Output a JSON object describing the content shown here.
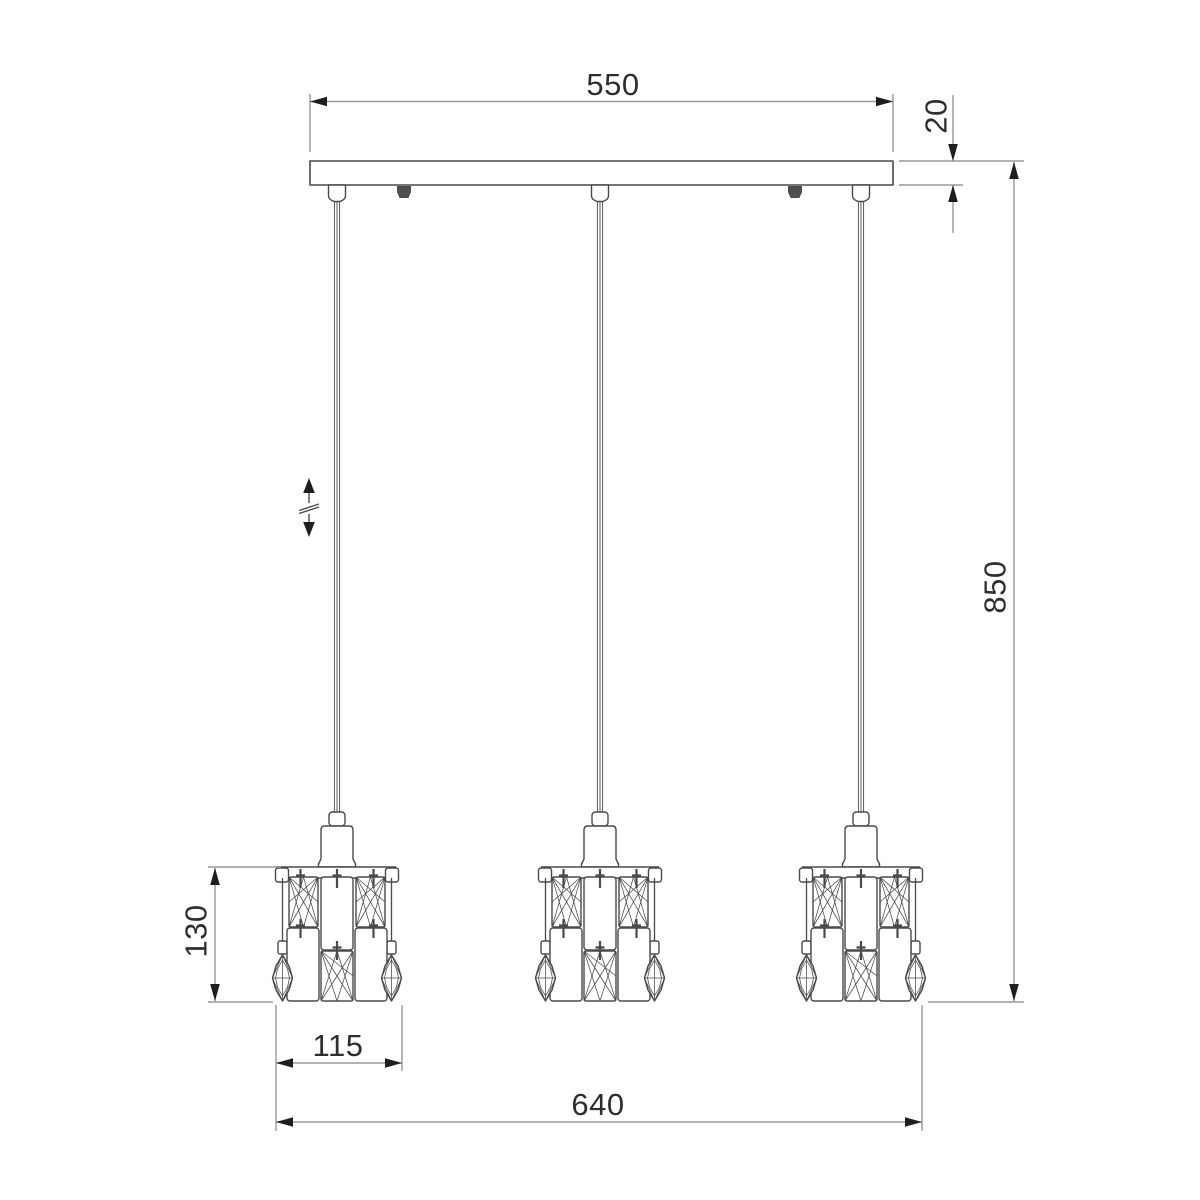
{
  "colors": {
    "background": "#ffffff",
    "line": "#4a4a4a",
    "dim_line": "#989898",
    "arrow": "#1e1e1e",
    "text": "#2e2e2e",
    "screw_fill": "#4f4f4f"
  },
  "dimensions": {
    "canopy_width": "550",
    "canopy_thickness": "20",
    "overall_drop": "850",
    "shade_height": "130",
    "shade_width": "115",
    "overall_width": "640"
  },
  "icons": {
    "height_adjust": "double-vertical-arrow-with-break-mark"
  }
}
